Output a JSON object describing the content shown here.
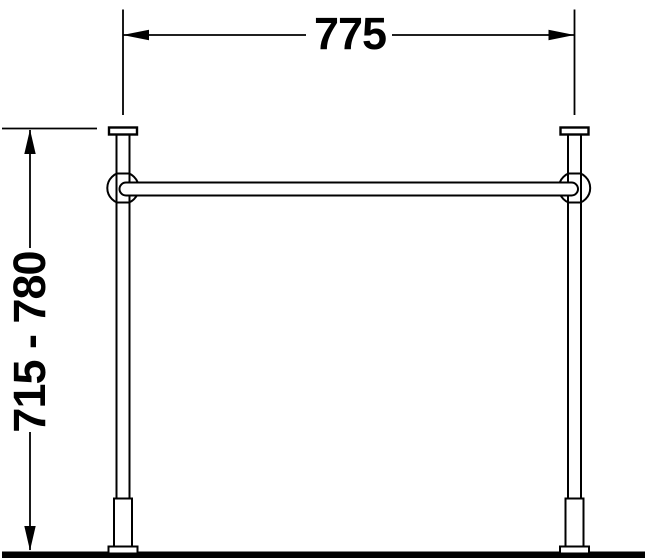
{
  "drawing": {
    "colors": {
      "line": "#000000",
      "background": "#ffffff"
    },
    "dimensions": {
      "width": {
        "label": "775"
      },
      "height": {
        "label": "715 - 780"
      }
    }
  }
}
